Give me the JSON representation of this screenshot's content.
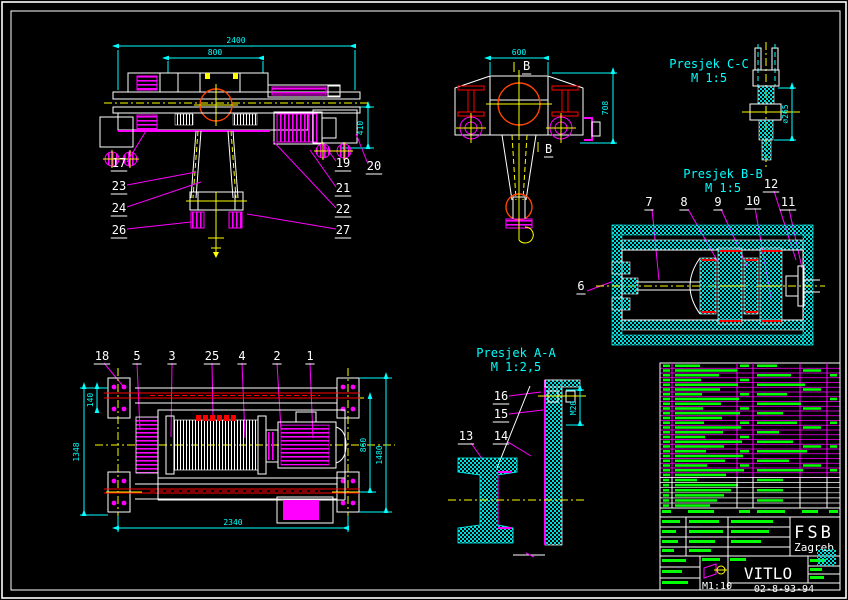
{
  "sheet": {
    "background": "#000000",
    "frame_color": "#ffffff"
  },
  "palette": {
    "white": "#ffffff",
    "cyan": "#00ffff",
    "magenta": "#ff00ff",
    "yellow": "#ffff00",
    "red": "#ff0000",
    "green": "#00ff00"
  },
  "sections": {
    "cc": {
      "title": "Presjek C-C",
      "scale": "M 1:5"
    },
    "bb": {
      "title": "Presjek B-B",
      "scale": "M 1:5"
    },
    "aa": {
      "title": "Presjek A-A",
      "scale": "M 1:2,5"
    }
  },
  "dims": {
    "front_total": "2400",
    "front_drum": "800",
    "front_height": "410",
    "end_width": "600",
    "end_height": "708",
    "cc_dia": "⌀265",
    "plan_h1": "1348",
    "plan_h2": "140",
    "plan_h3": "860",
    "plan_h4": "1480",
    "plan_total": "2340",
    "aa_bolt": "M20"
  },
  "section_marks": {
    "b_top": "B",
    "b_bottom": "B"
  },
  "callouts": {
    "1": "1",
    "2": "2",
    "3": "3",
    "4": "4",
    "5": "5",
    "6": "6",
    "7": "7",
    "8": "8",
    "9": "9",
    "10": "10",
    "11": "11",
    "12": "12",
    "13": "13",
    "14": "14",
    "15": "15",
    "16": "16",
    "17": "17",
    "18": "18",
    "19": "19",
    "20": "20",
    "21": "21",
    "22": "22",
    "23": "23",
    "24": "24",
    "25": "25",
    "26": "26",
    "27": "27"
  },
  "bom": {
    "row_count": 24,
    "extra_row_count": 6,
    "legible": false
  },
  "title_block": {
    "company": "FSB",
    "city": "Zagreb",
    "part_name": "VITLO",
    "drawing_number": "02-8-93-94",
    "scale": "M1:10"
  }
}
